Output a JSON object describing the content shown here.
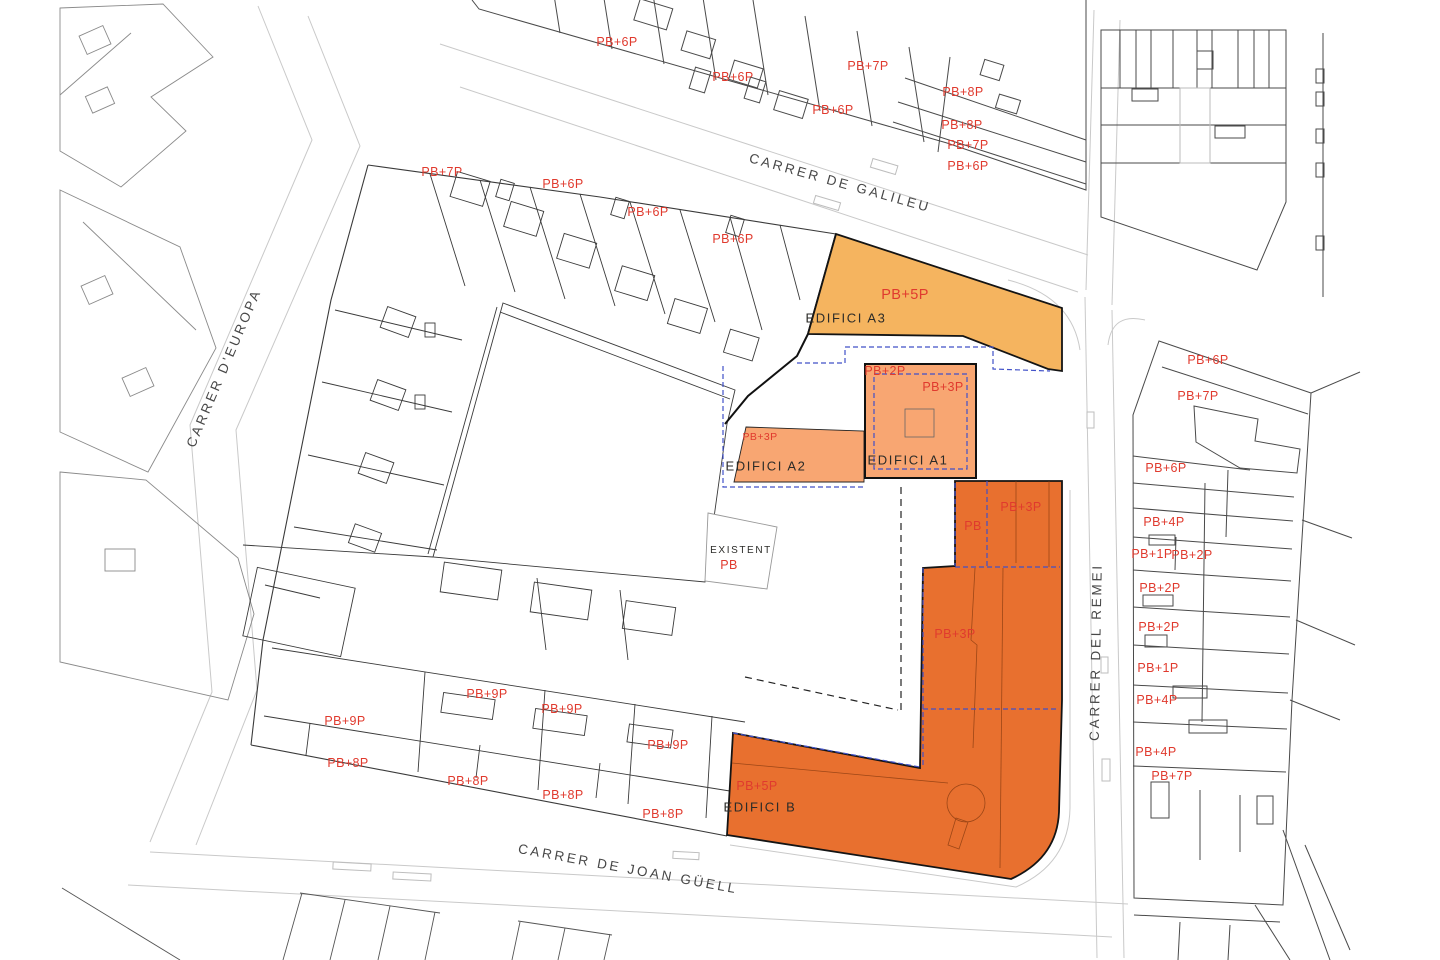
{
  "plan": {
    "colors": {
      "red_label": "#e03a2e",
      "name_label": "#2b2b28",
      "street_label": "#474747",
      "a3_fill": "#f5b45f",
      "a_fill": "#f8a672",
      "b_fill": "#e8702f",
      "blue_dash": "#4050c8"
    },
    "buildings": [
      {
        "id": "edifici-a3",
        "name": "EDIFICI A3",
        "floors": "PB+5P"
      },
      {
        "id": "edifici-a2",
        "name": "EDIFICI A2",
        "floors": "PB+3P"
      },
      {
        "id": "edifici-a1",
        "name": "EDIFICI A1",
        "floors": "PB+2P, PB+3P"
      },
      {
        "id": "edifici-b",
        "name": "EDIFICI B",
        "floors": "PB, PB+3P, PB+5P"
      },
      {
        "id": "existent",
        "name": "EXISTENT",
        "floors": "PB"
      }
    ],
    "street_labels": [
      {
        "text": "CARRER DE GALILEU",
        "x": 840,
        "y": 183,
        "rot": 15.5
      },
      {
        "text": "CARRER D'EUROPA",
        "x": 224,
        "y": 368,
        "rot": -67
      },
      {
        "text": "CARRER DEL REMEI",
        "x": 1096,
        "y": 652,
        "rot": -89
      },
      {
        "text": "CARRER DE JOAN GÜELL",
        "x": 628,
        "y": 869,
        "rot": 10.5
      }
    ],
    "building_name_labels": [
      {
        "text": "EDIFICI A3",
        "x": 846,
        "y": 318
      },
      {
        "text": "EDIFICI A2",
        "x": 766,
        "y": 466
      },
      {
        "text": "EDIFICI A1",
        "x": 908,
        "y": 460
      },
      {
        "text": "EDIFICI B",
        "x": 760,
        "y": 807
      },
      {
        "text": "EXISTENT",
        "x": 741,
        "y": 551,
        "s": 10
      }
    ],
    "floor_labels": [
      {
        "text": "PB+6P",
        "x": 617,
        "y": 42
      },
      {
        "text": "PB+7P",
        "x": 868,
        "y": 66
      },
      {
        "text": "PB+6P",
        "x": 733,
        "y": 77
      },
      {
        "text": "PB+8P",
        "x": 963,
        "y": 92
      },
      {
        "text": "PB+6P",
        "x": 833,
        "y": 110
      },
      {
        "text": "PB+8P",
        "x": 962,
        "y": 125
      },
      {
        "text": "PB+7P",
        "x": 968,
        "y": 145
      },
      {
        "text": "PB+6P",
        "x": 968,
        "y": 166
      },
      {
        "text": "PB+7P",
        "x": 442,
        "y": 172
      },
      {
        "text": "PB+6P",
        "x": 563,
        "y": 184
      },
      {
        "text": "PB+6P",
        "x": 648,
        "y": 212
      },
      {
        "text": "PB+6P",
        "x": 733,
        "y": 239
      },
      {
        "text": "PB+5P",
        "x": 905,
        "y": 295,
        "s": 14.5
      },
      {
        "text": "PB+2P",
        "x": 885,
        "y": 371
      },
      {
        "text": "PB+3P",
        "x": 943,
        "y": 387
      },
      {
        "text": "PB+3P",
        "x": 760,
        "y": 437,
        "s": 10.5
      },
      {
        "text": "PB",
        "x": 729,
        "y": 565
      },
      {
        "text": "PB",
        "x": 973,
        "y": 526
      },
      {
        "text": "PB+3P",
        "x": 1021,
        "y": 507
      },
      {
        "text": "PB+3P",
        "x": 955,
        "y": 634
      },
      {
        "text": "PB+5P",
        "x": 757,
        "y": 786
      },
      {
        "text": "PB+6P",
        "x": 1208,
        "y": 360
      },
      {
        "text": "PB+7P",
        "x": 1198,
        "y": 396
      },
      {
        "text": "PB+6P",
        "x": 1166,
        "y": 468
      },
      {
        "text": "PB+4P",
        "x": 1164,
        "y": 522
      },
      {
        "text": "PB+1P",
        "x": 1152,
        "y": 554
      },
      {
        "text": "PB+2P",
        "x": 1192,
        "y": 555
      },
      {
        "text": "PB+2P",
        "x": 1160,
        "y": 588
      },
      {
        "text": "PB+2P",
        "x": 1159,
        "y": 627
      },
      {
        "text": "PB+1P",
        "x": 1158,
        "y": 668
      },
      {
        "text": "PB+4P",
        "x": 1157,
        "y": 700
      },
      {
        "text": "PB+4P",
        "x": 1156,
        "y": 752
      },
      {
        "text": "PB+7P",
        "x": 1172,
        "y": 776
      },
      {
        "text": "PB+9P",
        "x": 345,
        "y": 721
      },
      {
        "text": "PB+9P",
        "x": 487,
        "y": 694
      },
      {
        "text": "PB+9P",
        "x": 562,
        "y": 709
      },
      {
        "text": "PB+9P",
        "x": 668,
        "y": 745
      },
      {
        "text": "PB+8P",
        "x": 348,
        "y": 763
      },
      {
        "text": "PB+8P",
        "x": 468,
        "y": 781
      },
      {
        "text": "PB+8P",
        "x": 563,
        "y": 795
      },
      {
        "text": "PB+8P",
        "x": 663,
        "y": 814
      }
    ]
  }
}
